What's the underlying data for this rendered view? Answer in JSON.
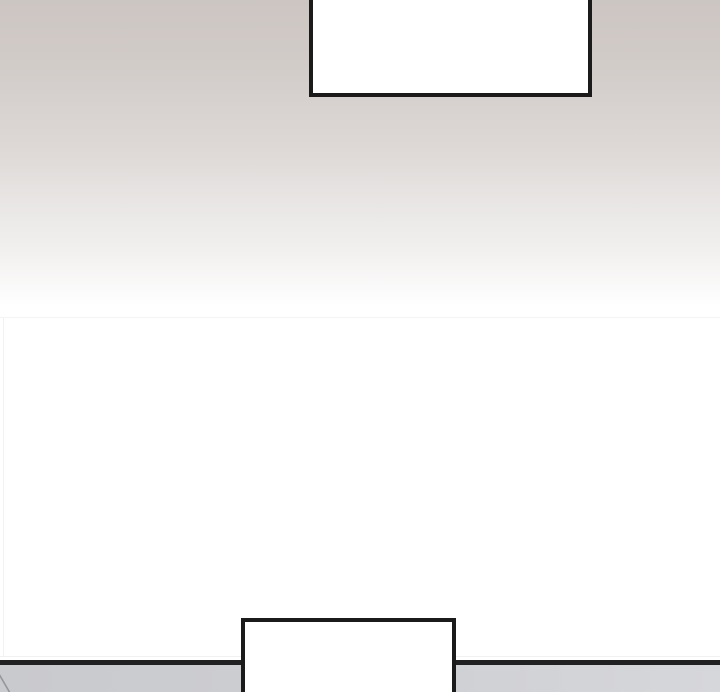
{
  "bubbles": {
    "top": {
      "text": ""
    },
    "bottom": {
      "text": ""
    }
  },
  "colors": {
    "gradient-top": "#ccc5c2",
    "gradient-mid": "#ddd8d6",
    "gradient-low": "#f2f0ef",
    "panel-white": "#ffffff",
    "bubble-fill": "#ffffff",
    "bubble-border": "#1b1b1b",
    "floor-line": "#212121",
    "floor-left": "#c9cacd",
    "floor-right": "#d6d7da",
    "seam": "#f4f4f4",
    "sketch": "#8d8d95"
  }
}
